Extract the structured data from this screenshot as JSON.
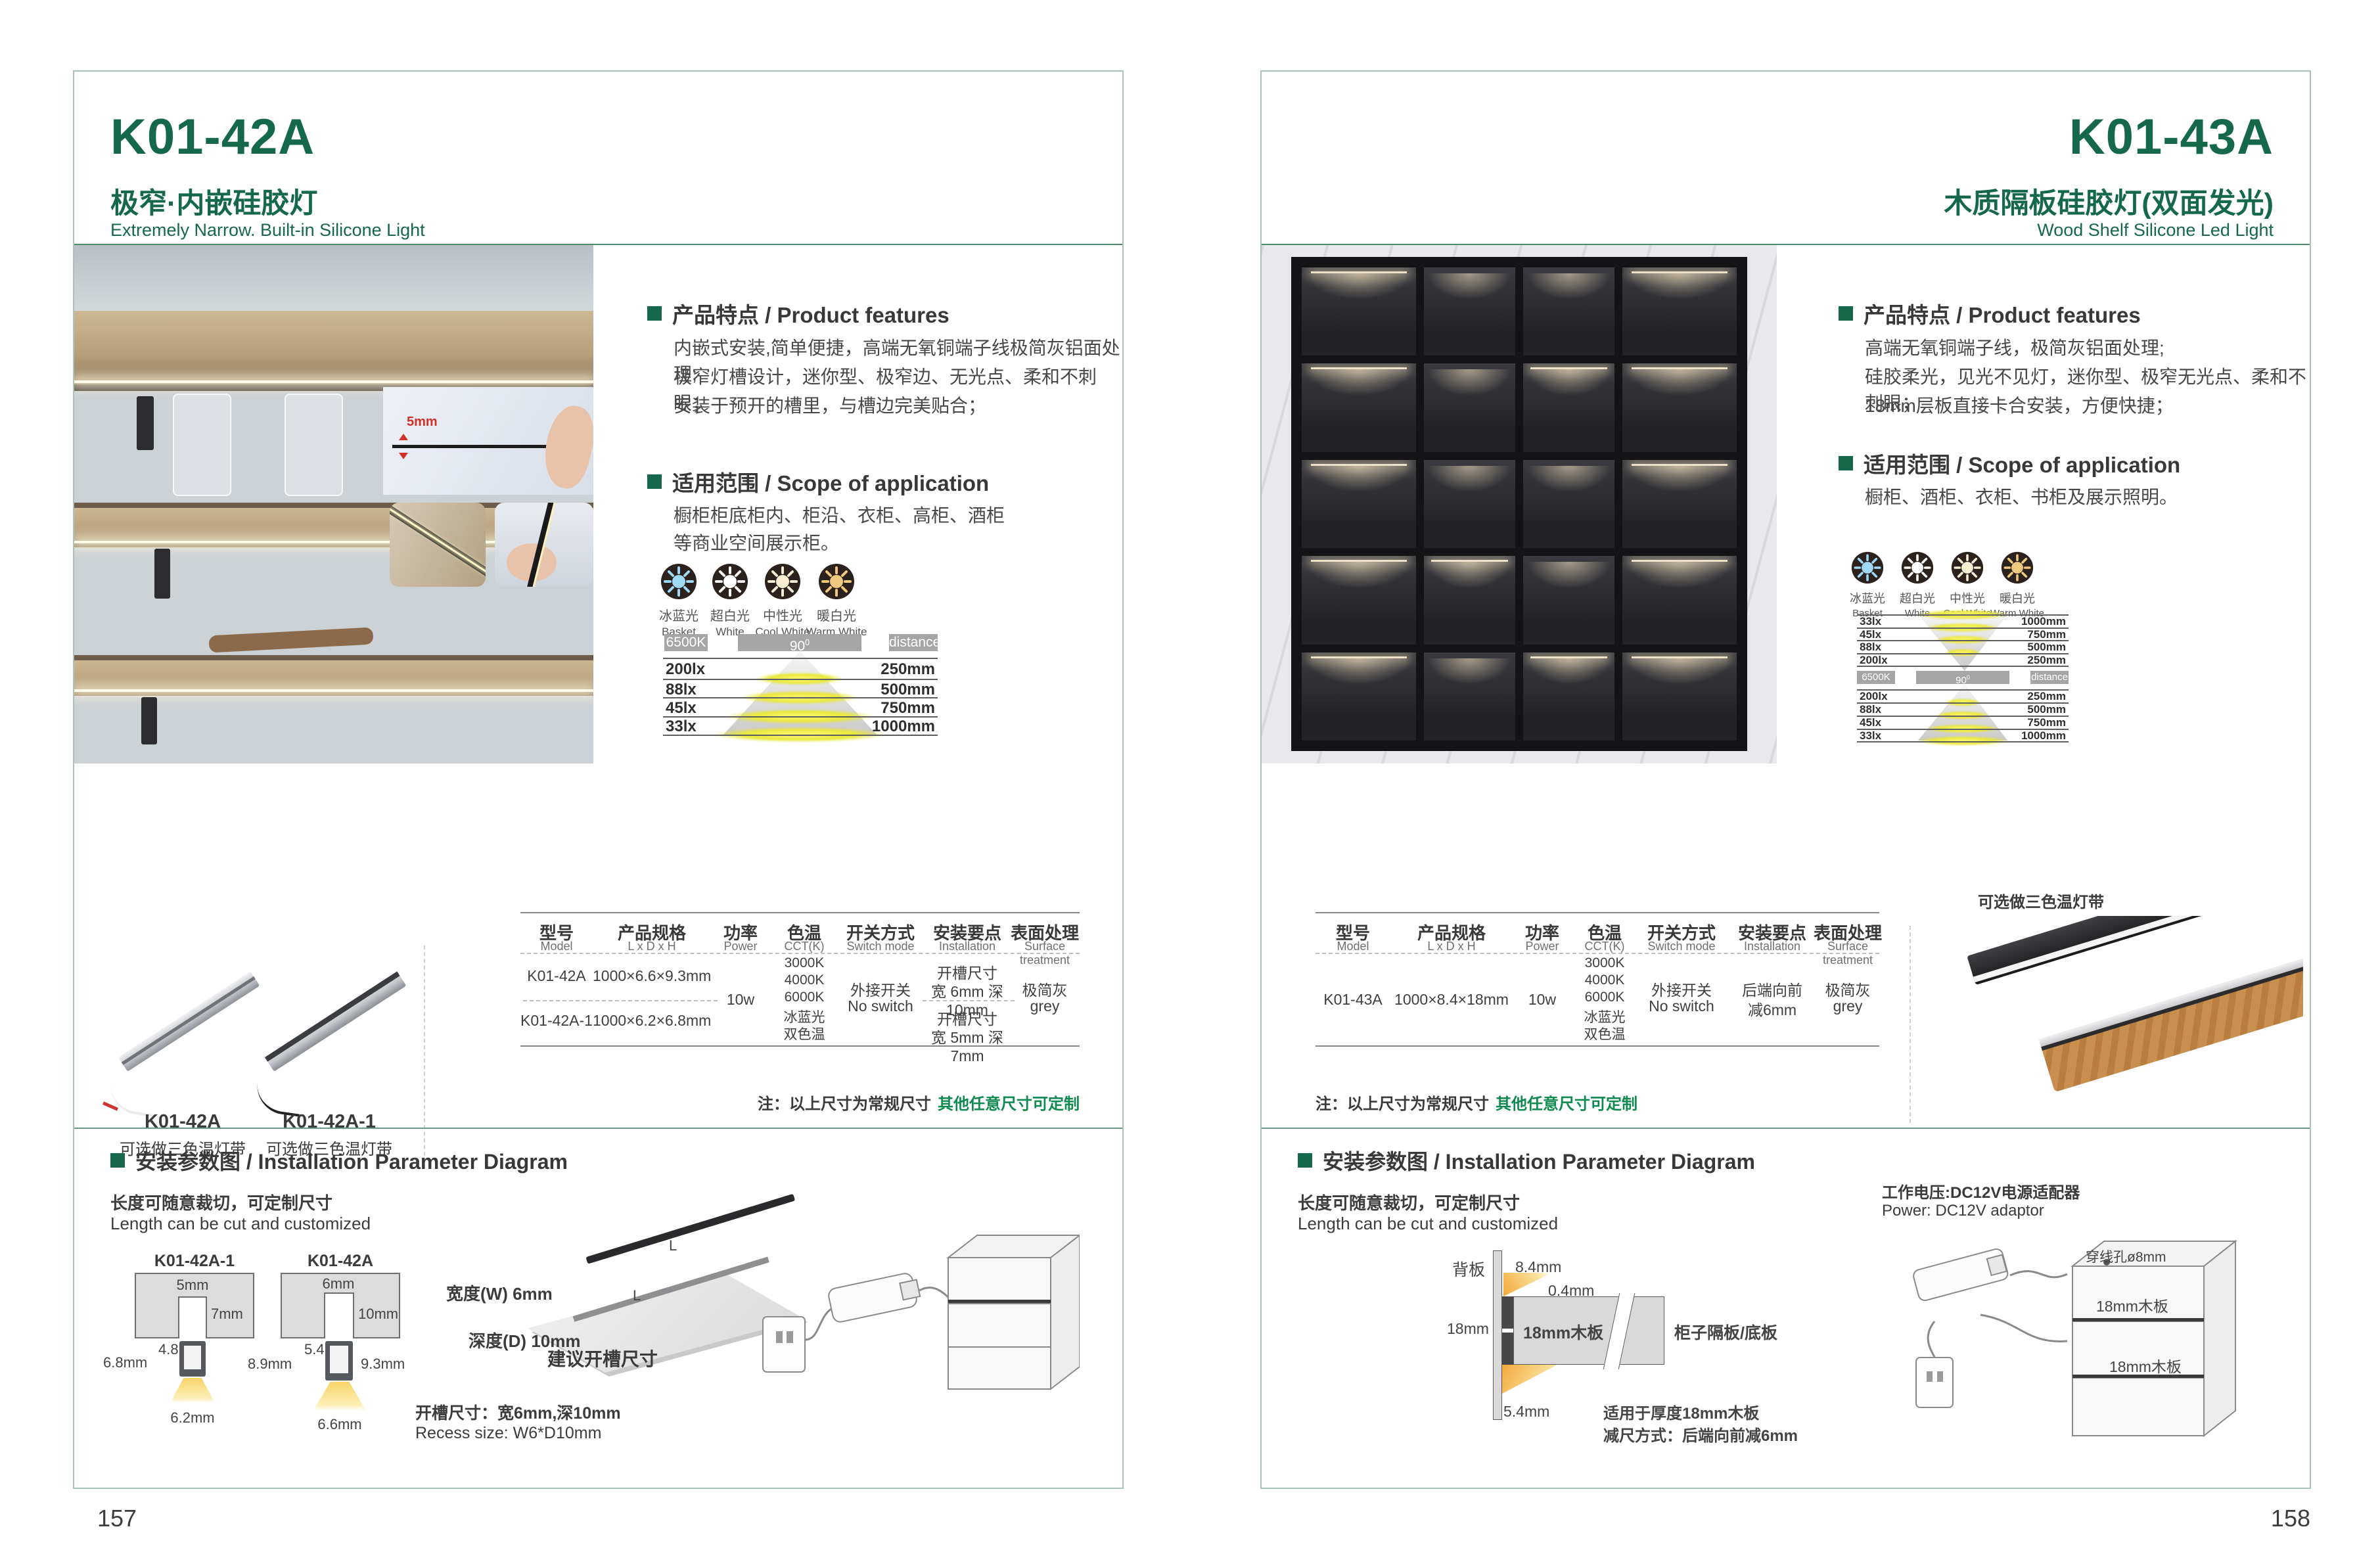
{
  "brand": {
    "green": "#15694a",
    "rule_green": "#4d8a6e",
    "note_green": "#0f8a4e"
  },
  "left": {
    "page_number": "157",
    "model": "K01-42A",
    "title_zh": "极窄·内嵌硅胶灯",
    "title_en": "Extremely Narrow. Built-in Silicone Light",
    "features": {
      "heading": "产品特点 / Product features",
      "lines": [
        "内嵌式安装,简单便捷，高端无氧铜端子线极简灰铝面处理;",
        "极窄灯槽设计，迷你型、极窄边、无光点、柔和不刺眼；",
        "安装于预开的槽里，与槽边完美贴合；"
      ]
    },
    "scope": {
      "heading": "适用范围 / Scope of application",
      "lines": [
        "橱柜柜底柜内、柜沿、衣柜、高柜、酒柜",
        "等商业空间展示柜。"
      ]
    },
    "photo": {
      "dim_label": "5mm"
    },
    "cct_icons": [
      {
        "zh": "冰蓝光",
        "en": "Basket",
        "color": "#9fd9f6"
      },
      {
        "zh": "超白光",
        "en": "White",
        "color": "#ffffff"
      },
      {
        "zh": "中性光",
        "en": "Cool White",
        "color": "#f7eed3"
      },
      {
        "zh": "暖白光",
        "en": "Warm White",
        "color": "#f1c97e"
      }
    ],
    "beam": {
      "kelvin": "6500K",
      "angle": "90",
      "angle_sup": "0",
      "distance": "distance",
      "rows": [
        {
          "lux": "200lx",
          "dist": "250mm"
        },
        {
          "lux": "88lx",
          "dist": "500mm"
        },
        {
          "lux": "45lx",
          "dist": "750mm"
        },
        {
          "lux": "33lx",
          "dist": "1000mm"
        }
      ]
    },
    "products": [
      {
        "model": "K01-42A",
        "note": "可选做三色温灯带"
      },
      {
        "model": "K01-42A-1",
        "note": "可选做三色温灯带"
      }
    ],
    "table": {
      "headers": [
        {
          "zh": "型号",
          "en": "Model"
        },
        {
          "zh": "产品规格",
          "en": "L x D x H"
        },
        {
          "zh": "功率",
          "en": "Power"
        },
        {
          "zh": "色温",
          "en": "CCT(K)"
        },
        {
          "zh": "开关方式",
          "en": "Switch mode"
        },
        {
          "zh": "安装要点",
          "en": "Installation"
        },
        {
          "zh": "表面处理",
          "en": "Surface treatment"
        }
      ],
      "rows": [
        {
          "model": "K01-42A",
          "size": "1000×6.6×9.3mm"
        },
        {
          "model": "K01-42A-1",
          "size": "1000×6.2×6.8mm"
        }
      ],
      "power": "10w",
      "cct": [
        "3000K",
        "4000K",
        "6000K",
        "冰蓝光",
        "双色温"
      ],
      "switch_zh": "外接开关",
      "switch_en": "No switch",
      "install_a1": "开槽尺寸",
      "install_a2": "宽 6mm 深 10mm",
      "install_b1": "开槽尺寸",
      "install_b2": "宽 5mm 深 7mm",
      "surface_zh": "极简灰",
      "surface_en": "grey",
      "note_black": "注：以上尺寸为常规尺寸",
      "note_green": "其他任意尺寸可定制"
    },
    "install": {
      "heading": "安装参数图 / Installation Parameter Diagram",
      "cut_zh": "长度可随意裁切，可定制尺寸",
      "cut_en": "Length can be cut and customized",
      "d1": {
        "label": "K01-42A-1",
        "top": "5mm",
        "side": "7mm",
        "inner": "4.8mm",
        "height": "6.8mm",
        "bottom": "6.2mm"
      },
      "d2": {
        "label": "K01-42A",
        "top": "6mm",
        "side": "10mm",
        "inner": "5.4mm",
        "height": "8.9mm",
        "side2": "9.3mm",
        "bottom": "6.6mm"
      },
      "iso": {
        "width": "宽度(W) 6mm",
        "depth": "深度(D) 10mm",
        "caption": "建议开槽尺寸",
        "length": "L"
      },
      "recess_zh": "开槽尺寸：宽6mm,深10mm",
      "recess_en": "Recess size: W6*D10mm"
    }
  },
  "right": {
    "page_number": "158",
    "model": "K01-43A",
    "title_zh": "木质隔板硅胶灯(双面发光)",
    "title_en": "Wood Shelf Silicone Led Light",
    "features": {
      "heading": "产品特点 / Product features",
      "lines": [
        "高端无氧铜端子线，极简灰铝面处理;",
        "硅胶柔光，见光不见灯，迷你型、极窄无光点、柔和不刺眼；",
        "18mm层板直接卡合安装，方便快捷；"
      ]
    },
    "scope": {
      "heading": "适用范围 / Scope of application",
      "lines": [
        "橱柜、酒柜、衣柜、书柜及展示照明。"
      ]
    },
    "cct_icons": [
      {
        "zh": "冰蓝光",
        "en": "Basket",
        "color": "#9fd9f6"
      },
      {
        "zh": "超白光",
        "en": "White",
        "color": "#ffffff"
      },
      {
        "zh": "中性光",
        "en": "Cool White",
        "color": "#f7eed3"
      },
      {
        "zh": "暖白光",
        "en": "Warm White",
        "color": "#f1c97e"
      }
    ],
    "beam": {
      "kelvin": "6500K",
      "angle": "90",
      "angle_sup": "0",
      "distance": "distance",
      "rows_top": [
        {
          "lux": "33lx",
          "dist": "1000mm"
        },
        {
          "lux": "45lx",
          "dist": "750mm"
        },
        {
          "lux": "88lx",
          "dist": "500mm"
        },
        {
          "lux": "200lx",
          "dist": "250mm"
        }
      ],
      "rows_bottom": [
        {
          "lux": "200lx",
          "dist": "250mm"
        },
        {
          "lux": "88lx",
          "dist": "500mm"
        },
        {
          "lux": "45lx",
          "dist": "750mm"
        },
        {
          "lux": "33lx",
          "dist": "1000mm"
        }
      ]
    },
    "product_note": "可选做三色温灯带",
    "table": {
      "headers": [
        {
          "zh": "型号",
          "en": "Model"
        },
        {
          "zh": "产品规格",
          "en": "L x D x H"
        },
        {
          "zh": "功率",
          "en": "Power"
        },
        {
          "zh": "色温",
          "en": "CCT(K)"
        },
        {
          "zh": "开关方式",
          "en": "Switch mode"
        },
        {
          "zh": "安装要点",
          "en": "Installation"
        },
        {
          "zh": "表面处理",
          "en": "Surface treatment"
        }
      ],
      "row": {
        "model": "K01-43A",
        "size": "1000×8.4×18mm"
      },
      "power": "10w",
      "cct": [
        "3000K",
        "4000K",
        "6000K",
        "冰蓝光",
        "双色温"
      ],
      "switch_zh": "外接开关",
      "switch_en": "No switch",
      "install_1": "后端向前",
      "install_2": "减6mm",
      "surface_zh": "极简灰",
      "surface_en": "grey",
      "note_black": "注：以上尺寸为常规尺寸",
      "note_green": "其他任意尺寸可定制"
    },
    "install": {
      "heading": "安装参数图 / Installation Parameter Diagram",
      "cut_zh": "长度可随意裁切，可定制尺寸",
      "cut_en": "Length can be cut and customized",
      "backboard": "背板",
      "dim_84": "8.4mm",
      "dim_04": "0.4mm",
      "dim_18": "18mm",
      "dim_54": "5.4mm",
      "board_label": "18mm木板",
      "shelf_side": "柜子隔板/底板",
      "fit_note1": "适用于厚度18mm木板",
      "fit_note2": "减尺方式：后端向前减6mm",
      "power_zh": "工作电压:DC12V电源适配器",
      "power_en": "Power: DC12V adaptor",
      "hole": "穿线孔ø8mm",
      "shelf1": "18mm木板",
      "shelf2": "18mm木板"
    }
  }
}
